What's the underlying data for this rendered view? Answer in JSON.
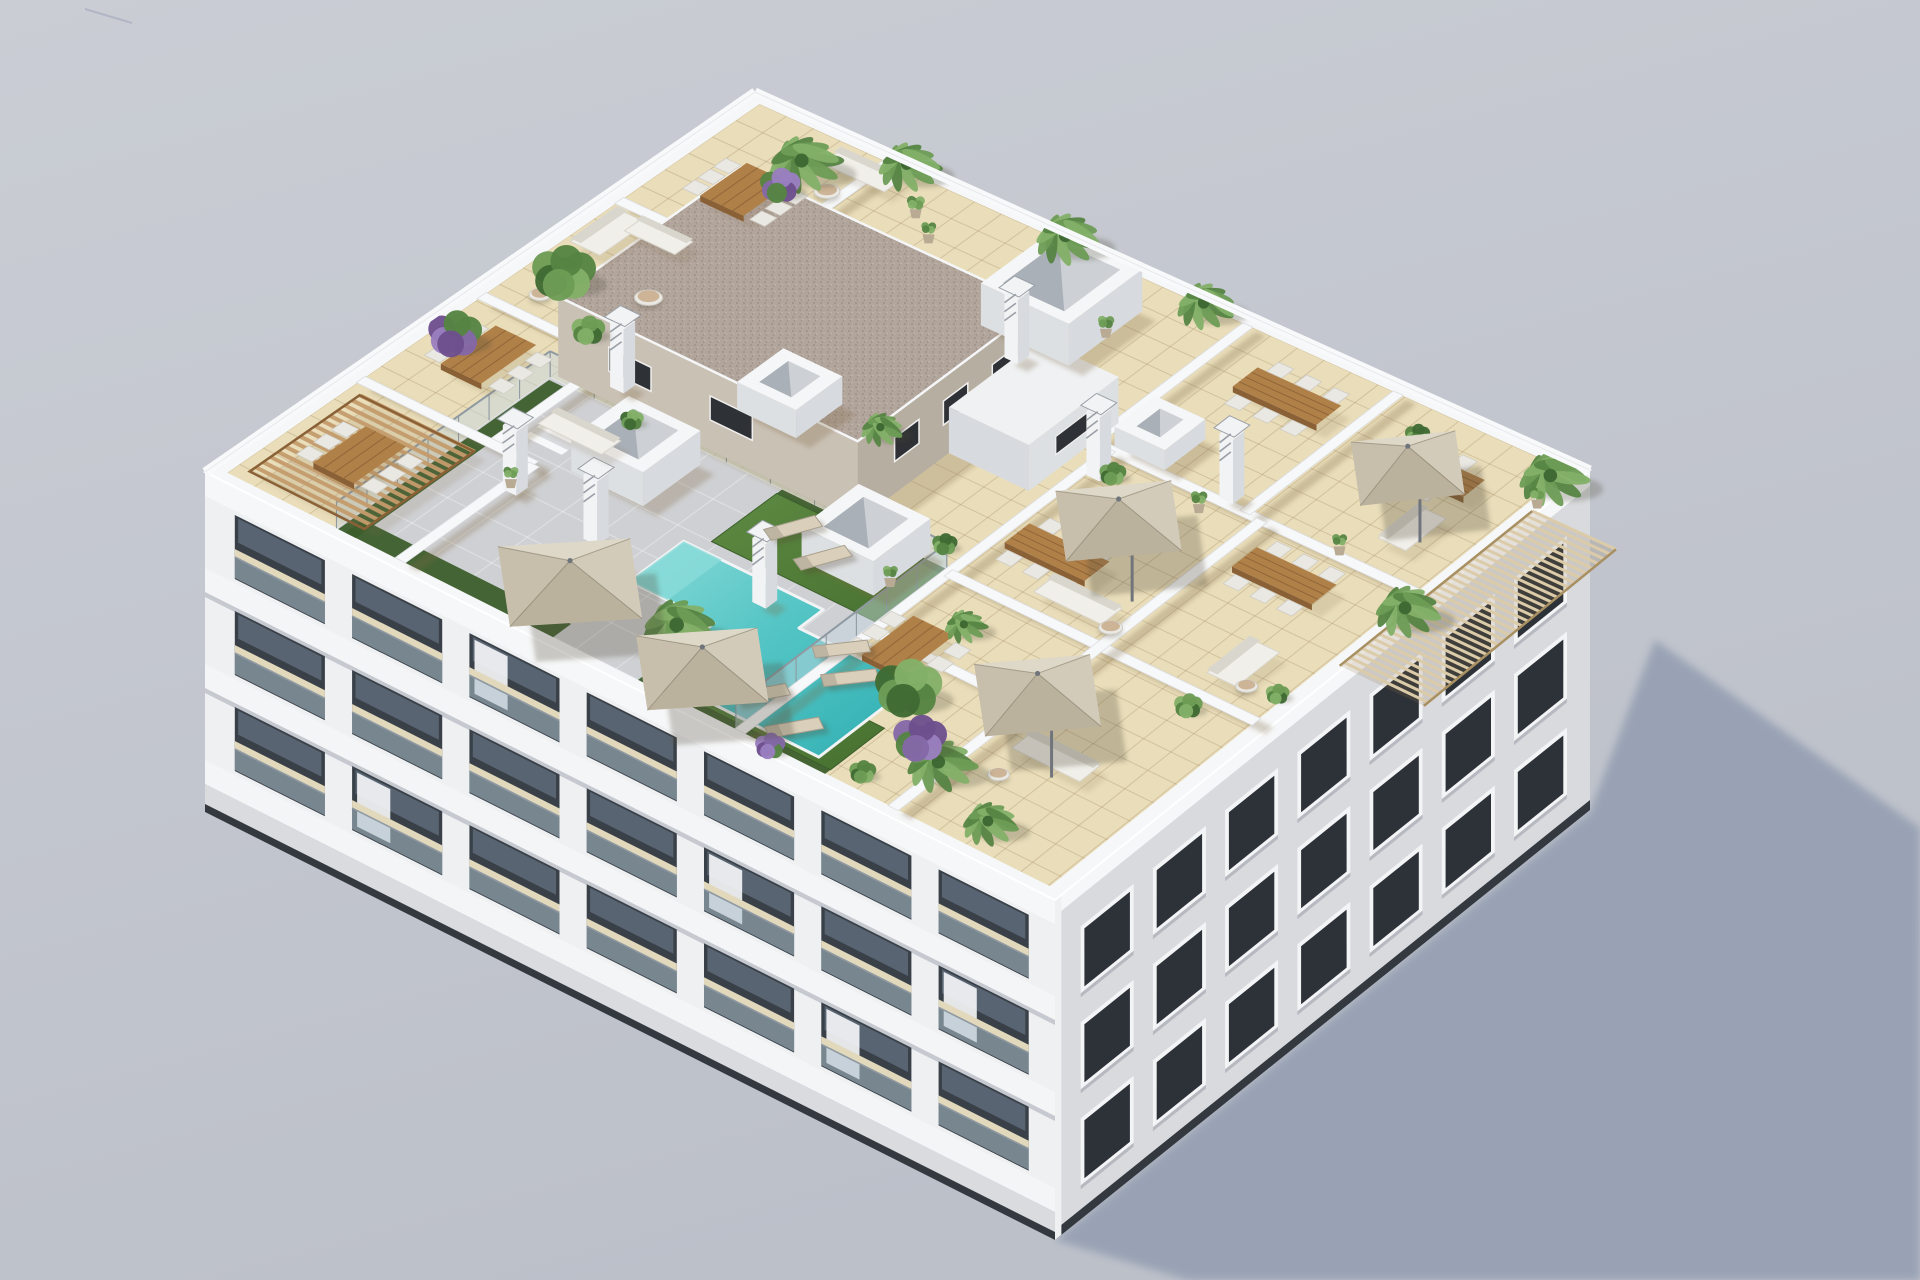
{
  "scene": {
    "description": "aerial-3d-architectural-render-apartment-building-rooftop-terraces-pool",
    "canvas": {
      "w": 1920,
      "h": 1280
    },
    "projection": {
      "N": [
        755,
        92
      ],
      "E": [
        1590,
        470
      ],
      "S": [
        1055,
        900
      ],
      "W": [
        205,
        472
      ],
      "wall_height": 340
    },
    "shadow_polygon": [
      [
        1055,
        1240
      ],
      [
        1590,
        812
      ],
      [
        1655,
        640
      ],
      [
        1920,
        828
      ],
      [
        1920,
        1280
      ],
      [
        1188,
        1280
      ]
    ],
    "colors": {
      "bg_top": "#cacdd4",
      "bg_bottom": "#bcc0c9",
      "sky_artifact": "#9aa0b8",
      "ground_shadow": "#96a0b3",
      "base_dark": "#34383f",
      "roof_rim": "#f6f7f8",
      "rim_shade": "#d9dbdf",
      "deck_tile": "#e9ddba",
      "deck_tile_line": "rgba(158,132,88,0.30)",
      "deck_wall_shadow": "rgba(125,104,68,0.28)",
      "pool_deck": "#cfd0d3",
      "pool_deck_line": "rgba(255,255,255,0.32)",
      "lawn_light": "#5d8a43",
      "lawn_dark": "#47702f",
      "hedge": "#3c5e2c",
      "pool_light": "#8adbd8",
      "pool_main": "#55c5c5",
      "pool_deep": "#2fafb2",
      "pool_coping": "#f2f3f4",
      "glass_panel": "rgba(196,215,224,0.48)",
      "glass_rail": "#8f99a2",
      "wall_white": "#f7f8f9",
      "wall_edge": "#dcdee2",
      "core_se": "#b7aea2",
      "core_sw": "#cac1b5",
      "core_roof": "#b2a59c",
      "core_roof_dot1": "#998c83",
      "core_roof_dot2": "#c3b8ae",
      "core_window": "#2e3135",
      "bulkhead_top": "#eff1f3",
      "bulkhead_face": "#dde0e3",
      "chimney_body": "#f2f3f5",
      "chimney_side": "#d7dade",
      "chimney_cap": "#9aa0a7",
      "skylight_rim": "#f5f6f7",
      "skylight_inner": "#aab0b7",
      "skylight_glass": "#d3d7db",
      "umbrella_1": "#ded8c9",
      "umbrella_2": "#d2cbba",
      "umbrella_3": "#c7bfac",
      "umbrella_4": "#bbb29e",
      "umbrella_pole": "#70757c",
      "wood_top": "#b08049",
      "wood_side": "#8a6136",
      "wood_line": "rgba(84,55,24,0.35)",
      "chair": "#eae8e3",
      "chair_edge": "#cfccc4",
      "sofa": "#f1efe9",
      "sofa_shade": "#d9d6cd",
      "lounger": "#d9cfba",
      "lounger_frame": "#a89f8e",
      "pergola_wood": "#c49b6b",
      "pergola_slat": "#dbcba9",
      "pergola_slat_line": "#a89062",
      "facade_sw_wall": "#eef0f2",
      "facade_sw_slab": "#f4f5f7",
      "facade_sw_slab_shadow": "#c6cad0",
      "facade_recess": "#394048",
      "facade_glass": "#5c6875",
      "balcony_glass": "rgba(173,191,204,0.55)",
      "balcony_floor": "#e2d8bc",
      "curtain": "#f3f4f6",
      "facade_se_wall": "#d8dade",
      "facade_se_frame": "#f3f4f6",
      "facade_se_glass": "#2d3138",
      "facade_se_sill": "#b6bac0",
      "plant_green_1": "#3f6a33",
      "plant_green_2": "#558443",
      "plant_green_3": "#6d9c55",
      "plant_green_4": "#83b068",
      "purple_1": "#6d4f8e",
      "purple_2": "#8468a8",
      "purple_3": "#9a7fc0",
      "pot": "#b9aa94",
      "trunk": "#7a5c3e",
      "plant_shadow": "rgba(70,68,50,0.25)",
      "umbrella_shadow": "rgba(80,75,55,0.28)"
    },
    "roof": {
      "inset": 0.016,
      "grid_step_a": 0.0322,
      "grid_step_b": 0.043,
      "gray_deck": {
        "a": [
          0.145,
          0.615
        ],
        "b": [
          0.595,
          0.985
        ]
      },
      "gray_step_a": 0.047,
      "gray_step_b": 0.065,
      "lawns": [
        {
          "a": [
            0.42,
            0.615
          ],
          "b": [
            0.605,
            0.725
          ]
        },
        {
          "a": [
            0.54,
            0.72
          ],
          "b": [
            0.875,
            0.975
          ]
        }
      ],
      "hedges": [
        {
          "a": [
            0.155,
            0.4
          ],
          "b": [
            0.952,
            0.985
          ]
        },
        {
          "a": [
            0.5,
            0.72
          ],
          "b": [
            0.952,
            0.985
          ]
        },
        {
          "a": [
            0.147,
            0.168
          ],
          "b": [
            0.6,
            0.985
          ]
        },
        {
          "a": [
            0.42,
            0.615
          ],
          "b": [
            0.595,
            0.612
          ]
        }
      ],
      "pool": [
        [
          0.4,
          0.745
        ],
        [
          0.565,
          0.745
        ],
        [
          0.565,
          0.79
        ],
        [
          0.7,
          0.79
        ],
        [
          0.7,
          0.965
        ],
        [
          0.5,
          0.965
        ],
        [
          0.5,
          0.845
        ],
        [
          0.4,
          0.845
        ]
      ],
      "pool_steps": [
        [
          0.4,
          0.745
        ],
        [
          0.445,
          0.745
        ],
        [
          0.445,
          0.845
        ],
        [
          0.4,
          0.845
        ]
      ],
      "glass_rails": [
        {
          "dir": "b",
          "at": 0.595,
          "f0": 0.145,
          "f1": 0.615
        },
        {
          "dir": "a",
          "at": 0.615,
          "f0": 0.595,
          "f1": 0.985
        },
        {
          "dir": "a",
          "at": 0.145,
          "f0": 0.595,
          "f1": 0.985
        }
      ],
      "stairs": {
        "a": 0.185,
        "b": 0.645,
        "n": 5
      },
      "walls": [
        {
          "dir": "a",
          "at": 0.17,
          "f0": 0.015,
          "f1": 0.74
        },
        {
          "dir": "b",
          "at": 0.27,
          "f0": 0.015,
          "f1": 0.17
        },
        {
          "dir": "b",
          "at": 0.52,
          "f0": 0.015,
          "f1": 0.17
        },
        {
          "dir": "b",
          "at": 0.74,
          "f0": 0.015,
          "f1": 0.22
        },
        {
          "dir": "a",
          "at": 0.22,
          "f0": 0.74,
          "f1": 0.985
        },
        {
          "dir": "a",
          "at": 0.6,
          "f0": 0.015,
          "f1": 0.3
        },
        {
          "dir": "b",
          "at": 0.3,
          "f0": 0.6,
          "f1": 0.985
        },
        {
          "dir": "a",
          "at": 0.78,
          "f0": 0.015,
          "f1": 0.3
        },
        {
          "dir": "a",
          "at": 0.62,
          "f0": 0.3,
          "f1": 0.985
        },
        {
          "dir": "b",
          "at": 0.6,
          "f0": 0.62,
          "f1": 0.985
        },
        {
          "dir": "a",
          "at": 0.8,
          "f0": 0.3,
          "f1": 0.985
        },
        {
          "dir": "b",
          "at": 0.74,
          "f0": 0.62,
          "f1": 0.8
        }
      ],
      "core": {
        "a": [
          0.15,
          0.505
        ],
        "b": [
          0.254,
          0.588
        ],
        "h": 80,
        "windows_se": [
          [
            0.295,
            0.34
          ],
          [
            0.385,
            0.43
          ],
          [
            0.475,
            0.52
          ]
        ],
        "windows_sw": [
          [
            0.21,
            0.26
          ],
          [
            0.33,
            0.38
          ]
        ]
      },
      "bulkhead": {
        "a": [
          0.505,
          0.6
        ],
        "b": [
          0.254,
          0.42
        ],
        "h": 46,
        "window": [
          0.3,
          0.37
        ]
      },
      "skylights": [
        {
          "a": 0.455,
          "b": 0.135,
          "da": 0.105,
          "db": 0.135,
          "h": 42
        },
        {
          "a": 0.295,
          "b": 0.67,
          "da": 0.085,
          "db": 0.105,
          "h": 34
        },
        {
          "a": 0.545,
          "b": 0.635,
          "da": 0.085,
          "db": 0.105,
          "h": 34
        },
        {
          "a": 0.345,
          "b": 0.465,
          "da": 0.07,
          "db": 0.085,
          "h": 28
        },
        {
          "a": 0.65,
          "b": 0.255,
          "da": 0.06,
          "db": 0.075,
          "h": 20
        }
      ],
      "chimneys": [
        {
          "a": 0.46,
          "b": 0.225
        },
        {
          "a": 0.635,
          "b": 0.345
        },
        {
          "a": 0.755,
          "b": 0.285
        },
        {
          "a": 0.23,
          "b": 0.79
        },
        {
          "a": 0.335,
          "b": 0.805
        },
        {
          "a": 0.515,
          "b": 0.775
        },
        {
          "a": 0.205,
          "b": 0.555
        }
      ],
      "umbrellas": [
        {
          "a": 0.375,
          "b": 0.915,
          "s": 0.085,
          "pole": "center"
        },
        {
          "a": 0.55,
          "b": 0.945,
          "s": 0.078,
          "pole": "center"
        },
        {
          "a": 0.71,
          "b": 0.425,
          "s": 0.075,
          "pole": "corner"
        },
        {
          "a": 0.815,
          "b": 0.74,
          "s": 0.075,
          "pole": "corner"
        },
        {
          "a": 0.875,
          "b": 0.145,
          "s": 0.068,
          "pole": "corner"
        }
      ],
      "pergola_wood": {
        "a": [
          0.03,
          0.165
        ],
        "b": [
          0.765,
          0.965
        ]
      },
      "pergola_slat": {
        "a": [
          0.995,
          1.095
        ],
        "b": [
          0.1,
          0.46
        ]
      },
      "furniture": {
        "dining_sets": [
          {
            "a": 0.1,
            "b": 0.17,
            "da": 0.052,
            "db": 0.085,
            "chairs": 6
          },
          {
            "a": 0.085,
            "b": 0.615,
            "da": 0.048,
            "db": 0.1,
            "chairs": 6
          },
          {
            "a": 0.095,
            "b": 0.865,
            "da": 0.048,
            "db": 0.095,
            "chairs": 6
          },
          {
            "a": 0.705,
            "b": 0.105,
            "da": 0.1,
            "db": 0.046,
            "chairs": 6
          },
          {
            "a": 0.685,
            "b": 0.5,
            "da": 0.095,
            "db": 0.046,
            "chairs": 6
          },
          {
            "a": 0.875,
            "b": 0.375,
            "da": 0.095,
            "db": 0.046,
            "chairs": 6
          },
          {
            "a": 0.665,
            "b": 0.745,
            "da": 0.048,
            "db": 0.095,
            "chairs": 6
          },
          {
            "a": 0.9,
            "b": 0.115,
            "da": 0.07,
            "db": 0.04,
            "chairs": 2
          }
        ],
        "sofas": [
          {
            "a": 0.165,
            "b": 0.055,
            "da": 0.075,
            "db": 0.035
          },
          {
            "a": 0.045,
            "b": 0.335,
            "da": 0.035,
            "db": 0.085
          },
          {
            "a": 0.085,
            "b": 0.305,
            "da": 0.06,
            "db": 0.033
          },
          {
            "a": 0.745,
            "b": 0.555,
            "da": 0.08,
            "db": 0.038
          },
          {
            "a": 0.925,
            "b": 0.53,
            "da": 0.035,
            "db": 0.08
          },
          {
            "a": 0.875,
            "b": 0.8,
            "da": 0.08,
            "db": 0.038
          },
          {
            "a": 0.925,
            "b": 0.215,
            "da": 0.033,
            "db": 0.075
          },
          {
            "a": 0.225,
            "b": 0.665,
            "da": 0.075,
            "db": 0.035
          }
        ],
        "round_tables": [
          {
            "a": 0.135,
            "b": 0.4,
            "r": 14
          },
          {
            "a": 0.055,
            "b": 0.475,
            "r": 11
          },
          {
            "a": 0.79,
            "b": 0.565,
            "r": 12
          },
          {
            "a": 0.945,
            "b": 0.555,
            "r": 11
          },
          {
            "a": 0.155,
            "b": 0.105,
            "r": 13
          },
          {
            "a": 0.845,
            "b": 0.86,
            "r": 11
          }
        ],
        "loungers": [
          {
            "a": 0.465,
            "b": 0.645,
            "rot": -24
          },
          {
            "a": 0.515,
            "b": 0.668,
            "rot": -24
          },
          {
            "a": 0.615,
            "b": 0.79,
            "rot": -10
          },
          {
            "a": 0.648,
            "b": 0.826,
            "rot": -10
          },
          {
            "a": 0.6,
            "b": 0.915,
            "rot": -16
          },
          {
            "a": 0.655,
            "b": 0.94,
            "rot": -16
          }
        ]
      },
      "plants": [
        {
          "kind": "palm",
          "a": 0.105,
          "b": 0.075,
          "r": 44
        },
        {
          "kind": "palm",
          "a": 0.185,
          "b": 0.005,
          "r": 38
        },
        {
          "kind": "palm",
          "a": 0.375,
          "b": 0.005,
          "r": 40
        },
        {
          "kind": "palm",
          "a": 0.545,
          "b": 0.012,
          "r": 36
        },
        {
          "kind": "palm",
          "a": 0.975,
          "b": 0.035,
          "r": 42
        },
        {
          "kind": "palm",
          "a": 0.99,
          "b": 0.33,
          "r": 40
        },
        {
          "kind": "palm",
          "a": 0.475,
          "b": 0.875,
          "r": 46
        },
        {
          "kind": "palm",
          "a": 0.79,
          "b": 0.885,
          "r": 42
        },
        {
          "kind": "palm",
          "a": 0.88,
          "b": 0.935,
          "r": 34
        },
        {
          "kind": "palm",
          "a": 0.43,
          "b": 0.43,
          "r": 26
        },
        {
          "kind": "palm",
          "a": 0.68,
          "b": 0.665,
          "r": 26
        },
        {
          "kind": "bush",
          "a": 0.05,
          "b": 0.425,
          "r": 38
        },
        {
          "kind": "bush",
          "a": 0.125,
          "b": 0.495,
          "r": 20
        },
        {
          "kind": "bush",
          "a": 0.7,
          "b": 0.8,
          "r": 40
        },
        {
          "kind": "bush",
          "a": 0.59,
          "b": 0.56,
          "r": 15
        },
        {
          "kind": "bush",
          "a": 0.645,
          "b": 0.335,
          "r": 16
        },
        {
          "kind": "bush",
          "a": 0.92,
          "b": 0.625,
          "r": 17
        },
        {
          "kind": "bush",
          "a": 0.245,
          "b": 0.6,
          "r": 14
        },
        {
          "kind": "bush",
          "a": 0.835,
          "b": 0.065,
          "r": 15
        },
        {
          "kind": "bush",
          "a": 0.745,
          "b": 0.955,
          "r": 16
        },
        {
          "kind": "bush",
          "a": 0.975,
          "b": 0.545,
          "r": 14
        },
        {
          "kind": "purple",
          "a": 0.115,
          "b": 0.13,
          "r": 24
        },
        {
          "kind": "purple",
          "a": 0.035,
          "b": 0.6,
          "r": 32
        },
        {
          "kind": "purple",
          "a": 0.755,
          "b": 0.865,
          "r": 32
        },
        {
          "kind": "purple",
          "a": 0.655,
          "b": 0.985,
          "r": 18
        },
        {
          "kind": "pot",
          "a": 0.235,
          "b": 0.065,
          "r": 12
        },
        {
          "kind": "pot",
          "a": 0.27,
          "b": 0.095,
          "r": 10
        },
        {
          "kind": "pot",
          "a": 0.495,
          "b": 0.115,
          "r": 11
        },
        {
          "kind": "pot",
          "a": 0.985,
          "b": 0.075,
          "r": 11
        },
        {
          "kind": "pot",
          "a": 0.735,
          "b": 0.315,
          "r": 11
        },
        {
          "kind": "pot",
          "a": 0.58,
          "b": 0.645,
          "r": 10
        },
        {
          "kind": "pot",
          "a": 0.215,
          "b": 0.775,
          "r": 10
        },
        {
          "kind": "pot",
          "a": 0.88,
          "b": 0.28,
          "r": 10
        }
      ]
    },
    "facades": {
      "sw": {
        "height": 340,
        "parapet": 24,
        "floors": [
          [
            24,
            96
          ],
          [
            120,
            192
          ],
          [
            216,
            288
          ]
        ],
        "slabs": [
          [
            96,
            120
          ],
          [
            192,
            216
          ],
          [
            288,
            312
          ]
        ],
        "bays": 7,
        "bay_start": 0.035,
        "bay_step": 0.138,
        "bay_width": 0.106,
        "base_band": [
          312,
          340
        ],
        "base_line": [
          332,
          340
        ],
        "curtains": [
          [
            0,
            2
          ],
          [
            1,
            4
          ],
          [
            1,
            6
          ],
          [
            2,
            1
          ],
          [
            2,
            5
          ]
        ]
      },
      "se": {
        "height": 340,
        "rows": [
          [
            52,
            110
          ],
          [
            148,
            206
          ],
          [
            244,
            302
          ]
        ],
        "cols": 7,
        "col_start": 0.055,
        "col_step": 0.135,
        "win_width": 0.085,
        "base_line": [
          330,
          340
        ]
      }
    }
  }
}
